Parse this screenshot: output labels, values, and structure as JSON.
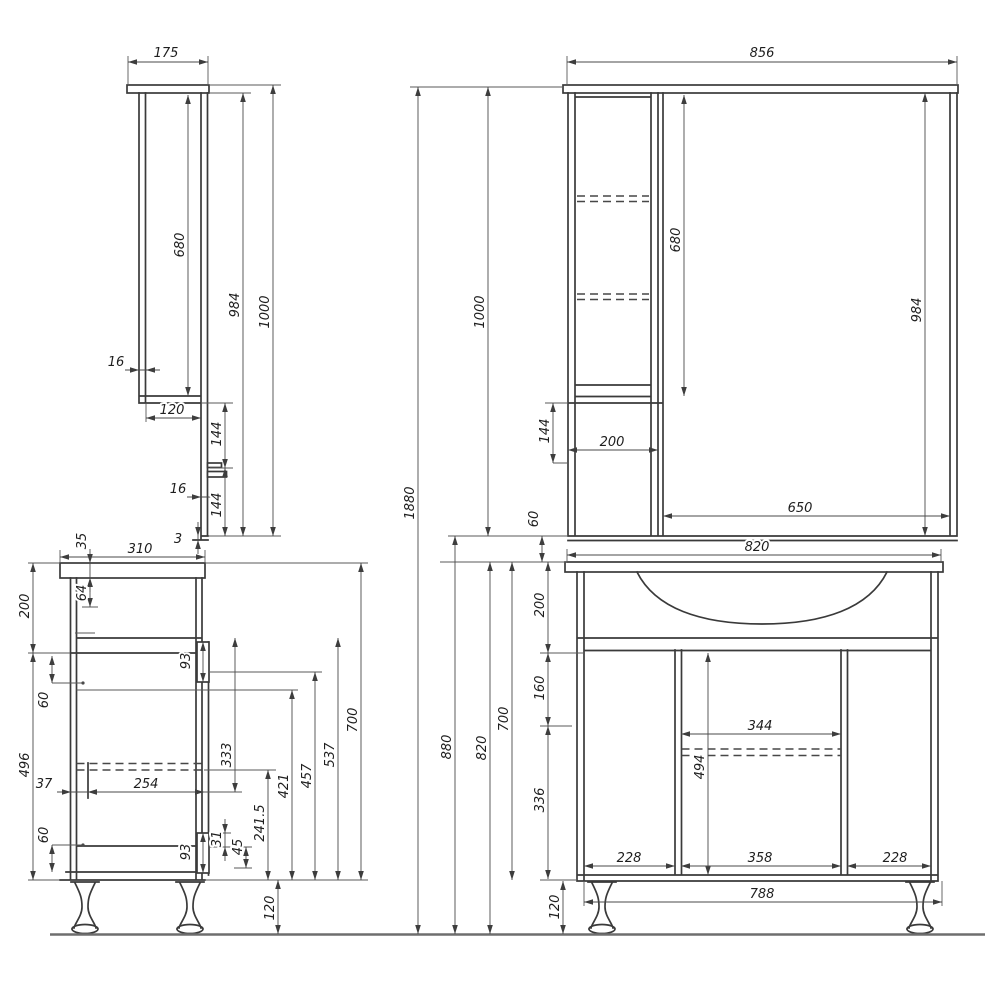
{
  "drawing": {
    "type": "furniture technical drawing",
    "subject": "bathroom vanity unit with mirror cabinet, four dimensioned orthographic views",
    "background_color": "#ffffff",
    "object_line_color": "#3a3a3a",
    "dimension_line_color": "#4a4a4a",
    "text_color": "#1e1e1e"
  },
  "views": {
    "mirror_cabinet_side": "top-left: side profile of mirror cabinet",
    "mirror_cabinet_front": "top-right: front of mirror cabinet with shelf column and mirror",
    "vanity_side": "bottom-left: side profile of floor vanity",
    "vanity_front": "bottom-right: front of floor vanity with sink top, two doors and centre section"
  },
  "dimensions": [
    {
      "name": "mirror-side-depth",
      "value": "175",
      "axis": "h",
      "x1": 128,
      "x2": 208,
      "y": 62,
      "lx": 166,
      "ly": 57
    },
    {
      "name": "mirror-side-cabinet-height",
      "value": "680",
      "axis": "v",
      "x": 188,
      "y1": 95,
      "y2": 396,
      "lx": 184,
      "ly": 245
    },
    {
      "name": "mirror-side-height-984",
      "value": "984",
      "axis": "v",
      "x": 243,
      "y1": 93,
      "y2": 536,
      "lx": 239,
      "ly": 305
    },
    {
      "name": "mirror-side-total-height",
      "value": "1000",
      "axis": "v",
      "x": 273,
      "y1": 85,
      "y2": 536,
      "lx": 269,
      "ly": 312
    },
    {
      "name": "mirror-side-panel-thickness",
      "value": "16",
      "axis": "h",
      "x1": 139,
      "x2": 146,
      "y": 370,
      "lx": 116,
      "ly": 366,
      "out": true
    },
    {
      "name": "mirror-side-cabinet-depth",
      "value": "120",
      "axis": "h",
      "x1": 146,
      "x2": 201,
      "y": 418,
      "lx": 172,
      "ly": 414
    },
    {
      "name": "mirror-side-gap-upper",
      "value": "144",
      "axis": "v",
      "x": 225,
      "y1": 403,
      "y2": 468,
      "lx": 221,
      "ly": 434
    },
    {
      "name": "mirror-side-ledge-thickness",
      "value": "16",
      "axis": "h",
      "x1": 201,
      "x2": 209,
      "y": 497,
      "lx": 178,
      "ly": 493,
      "out": true
    },
    {
      "name": "mirror-side-gap-lower",
      "value": "144",
      "axis": "v",
      "x": 225,
      "y1": 468,
      "y2": 536,
      "lx": 221,
      "ly": 505
    },
    {
      "name": "mirror-side-bottom-lip",
      "value": "3",
      "axis": "v",
      "x": 198,
      "y1": 536,
      "y2": 540,
      "lx": 178,
      "ly": 543,
      "out": true,
      "rot": false
    },
    {
      "name": "mirror-front-width",
      "value": "856",
      "axis": "h",
      "x1": 567,
      "x2": 957,
      "y": 62,
      "lx": 762,
      "ly": 57
    },
    {
      "name": "mirror-front-cabinet-height",
      "value": "680",
      "axis": "v",
      "x": 684,
      "y1": 95,
      "y2": 396,
      "lx": 680,
      "ly": 240
    },
    {
      "name": "mirror-front-height-984",
      "value": "984",
      "axis": "v",
      "x": 925,
      "y1": 93,
      "y2": 536,
      "lx": 921,
      "ly": 310
    },
    {
      "name": "mirror-front-total-height",
      "value": "1000",
      "axis": "v",
      "x": 488,
      "y1": 87,
      "y2": 536,
      "lx": 484,
      "ly": 312
    },
    {
      "name": "mirror-front-gap-144",
      "value": "144",
      "axis": "v",
      "x": 553,
      "y1": 403,
      "y2": 463,
      "lx": 549,
      "ly": 431
    },
    {
      "name": "mirror-front-column-width",
      "value": "200",
      "axis": "h",
      "x1": 568,
      "x2": 658,
      "y": 450,
      "lx": 612,
      "ly": 446
    },
    {
      "name": "mirror-front-mirror-width",
      "value": "650",
      "axis": "h",
      "x1": 663,
      "x2": 950,
      "y": 516,
      "lx": 800,
      "ly": 512
    },
    {
      "name": "mirror-front-gap-to-vanity",
      "value": "60",
      "axis": "v",
      "x": 542,
      "y1": 536,
      "y2": 562,
      "lx": 538,
      "ly": 519
    },
    {
      "name": "vanity-side-depth",
      "value": "310",
      "axis": "h",
      "x1": 60,
      "x2": 205,
      "y": 557,
      "lx": 140,
      "ly": 553
    },
    {
      "name": "vanity-side-top-thickness",
      "value": "35",
      "axis": "v",
      "x": 90,
      "y1": 563,
      "y2": 578,
      "lx": 86,
      "ly": 541,
      "out": true
    },
    {
      "name": "vanity-side-rail-64",
      "value": "64",
      "axis": "v",
      "x": 90,
      "y1": 578,
      "y2": 607,
      "lx": 86,
      "ly": 593
    },
    {
      "name": "vanity-side-apron-height",
      "value": "200",
      "axis": "v",
      "x": 33,
      "y1": 563,
      "y2": 653,
      "lx": 29,
      "ly": 606
    },
    {
      "name": "vanity-side-lower-height",
      "value": "496",
      "axis": "v",
      "x": 33,
      "y1": 653,
      "y2": 880,
      "lx": 29,
      "ly": 765
    },
    {
      "name": "vanity-side-offset-60-upper",
      "value": "60",
      "axis": "v",
      "x": 52,
      "y1": 656,
      "y2": 683,
      "lx": 48,
      "ly": 700
    },
    {
      "name": "vanity-side-offset-60-lower",
      "value": "60",
      "axis": "v",
      "x": 52,
      "y1": 845,
      "y2": 872,
      "lx": 48,
      "ly": 835
    },
    {
      "name": "vanity-side-back-gap",
      "value": "37",
      "axis": "h",
      "x1": 71,
      "x2": 88,
      "y": 792,
      "lx": 44,
      "ly": 788,
      "out": true
    },
    {
      "name": "vanity-side-drawer-depth",
      "value": "254",
      "axis": "h",
      "x1": 88,
      "x2": 204,
      "y": 792,
      "lx": 146,
      "ly": 788
    },
    {
      "name": "vanity-side-333",
      "value": "333",
      "axis": "v",
      "x": 235,
      "y1": 638,
      "y2": 792,
      "lx": 231,
      "ly": 755
    },
    {
      "name": "vanity-side-241-5",
      "value": "241.5",
      "axis": "v",
      "x": 268,
      "y1": 770,
      "y2": 880,
      "lx": 264,
      "ly": 823
    },
    {
      "name": "vanity-side-421",
      "value": "421",
      "axis": "v",
      "x": 292,
      "y1": 690,
      "y2": 880,
      "lx": 288,
      "ly": 786
    },
    {
      "name": "vanity-side-457",
      "value": "457",
      "axis": "v",
      "x": 315,
      "y1": 672,
      "y2": 880,
      "lx": 311,
      "ly": 776
    },
    {
      "name": "vanity-side-537",
      "value": "537",
      "axis": "v",
      "x": 338,
      "y1": 638,
      "y2": 880,
      "lx": 334,
      "ly": 755
    },
    {
      "name": "vanity-side-700",
      "value": "700",
      "axis": "v",
      "x": 361,
      "y1": 563,
      "y2": 880,
      "lx": 357,
      "ly": 720
    },
    {
      "name": "vanity-side-hinge-93-upper",
      "value": "93",
      "axis": "v",
      "x": 203,
      "y1": 642,
      "y2": 682,
      "lx": 190,
      "ly": 661
    },
    {
      "name": "vanity-side-hinge-93-lower",
      "value": "93",
      "axis": "v",
      "x": 203,
      "y1": 833,
      "y2": 873,
      "lx": 190,
      "ly": 852
    },
    {
      "name": "vanity-side-31",
      "value": "31",
      "axis": "v",
      "x": 225,
      "y1": 833,
      "y2": 847,
      "lx": 221,
      "ly": 839,
      "out": true
    },
    {
      "name": "vanity-side-45",
      "value": "45",
      "axis": "v",
      "x": 246,
      "y1": 847,
      "y2": 868,
      "lx": 242,
      "ly": 847
    },
    {
      "name": "vanity-side-leg-height",
      "value": "120",
      "axis": "v",
      "x": 278,
      "y1": 880,
      "y2": 934,
      "lx": 274,
      "ly": 908
    },
    {
      "name": "vanity-front-top-width",
      "value": "820",
      "axis": "h",
      "x1": 567,
      "x2": 941,
      "y": 555,
      "lx": 757,
      "ly": 551
    },
    {
      "name": "vanity-front-center-width",
      "value": "344",
      "axis": "h",
      "x1": 681,
      "x2": 841,
      "y": 734,
      "lx": 760,
      "ly": 730
    },
    {
      "name": "vanity-front-door-height",
      "value": "494",
      "axis": "v",
      "x": 708,
      "y1": 653,
      "y2": 875,
      "lx": 704,
      "ly": 767
    },
    {
      "name": "vanity-front-door-left-width",
      "value": "228",
      "axis": "h",
      "x1": 584,
      "x2": 675,
      "y": 866,
      "lx": 629,
      "ly": 862
    },
    {
      "name": "vanity-front-center-section-width",
      "value": "358",
      "axis": "h",
      "x1": 681,
      "x2": 841,
      "y": 866,
      "lx": 760,
      "ly": 862
    },
    {
      "name": "vanity-front-door-right-width",
      "value": "228",
      "axis": "h",
      "x1": 847,
      "x2": 931,
      "y": 866,
      "lx": 895,
      "ly": 862
    },
    {
      "name": "vanity-front-base-width",
      "value": "788",
      "axis": "h",
      "x1": 584,
      "x2": 942,
      "y": 902,
      "lx": 762,
      "ly": 898
    },
    {
      "name": "vanity-front-leg-height",
      "value": "120",
      "axis": "v",
      "x": 563,
      "y1": 881,
      "y2": 934,
      "lx": 559,
      "ly": 907
    },
    {
      "name": "overall-total-height",
      "value": "1880",
      "axis": "v",
      "x": 418,
      "y1": 87,
      "y2": 934,
      "lx": 414,
      "ly": 503
    },
    {
      "name": "overall-880",
      "value": "880",
      "axis": "v",
      "x": 455,
      "y1": 536,
      "y2": 934,
      "lx": 451,
      "ly": 747
    },
    {
      "name": "overall-820",
      "value": "820",
      "axis": "v",
      "x": 490,
      "y1": 562,
      "y2": 934,
      "lx": 486,
      "ly": 748
    },
    {
      "name": "overall-700",
      "value": "700",
      "axis": "v",
      "x": 512,
      "y1": 562,
      "y2": 880,
      "lx": 508,
      "ly": 719
    },
    {
      "name": "overall-200",
      "value": "200",
      "axis": "v",
      "x": 548,
      "y1": 562,
      "y2": 653,
      "lx": 544,
      "ly": 605
    },
    {
      "name": "overall-160",
      "value": "160",
      "axis": "v",
      "x": 548,
      "y1": 653,
      "y2": 726,
      "lx": 544,
      "ly": 688
    },
    {
      "name": "overall-336",
      "value": "336",
      "axis": "v",
      "x": 548,
      "y1": 726,
      "y2": 879,
      "lx": 544,
      "ly": 800
    }
  ]
}
